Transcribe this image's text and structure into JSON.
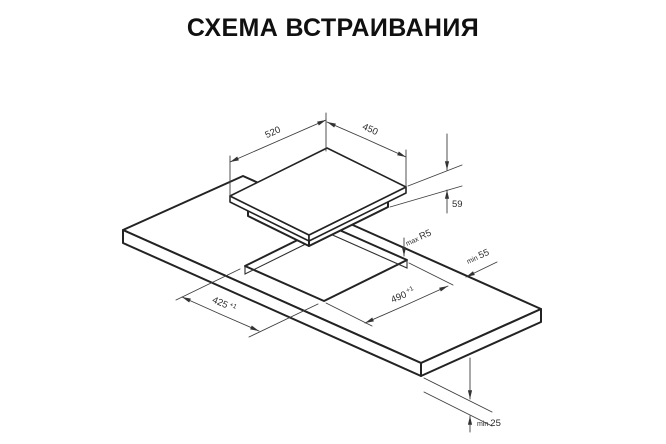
{
  "title": "СХЕМА ВСТРАИВАНИЯ",
  "diagram": {
    "dims": {
      "hob_width": "520",
      "hob_depth": "450",
      "hob_height": "59",
      "cutout_radius_prefix": "max",
      "cutout_radius": "R5",
      "edge_clearance_prefix": "min",
      "edge_clearance": "55",
      "cutout_width": "490",
      "cutout_width_tol": "+1",
      "cutout_depth": "425",
      "cutout_depth_tol": "+1",
      "bottom_clearance_prefix": "min",
      "bottom_clearance": "25"
    }
  }
}
